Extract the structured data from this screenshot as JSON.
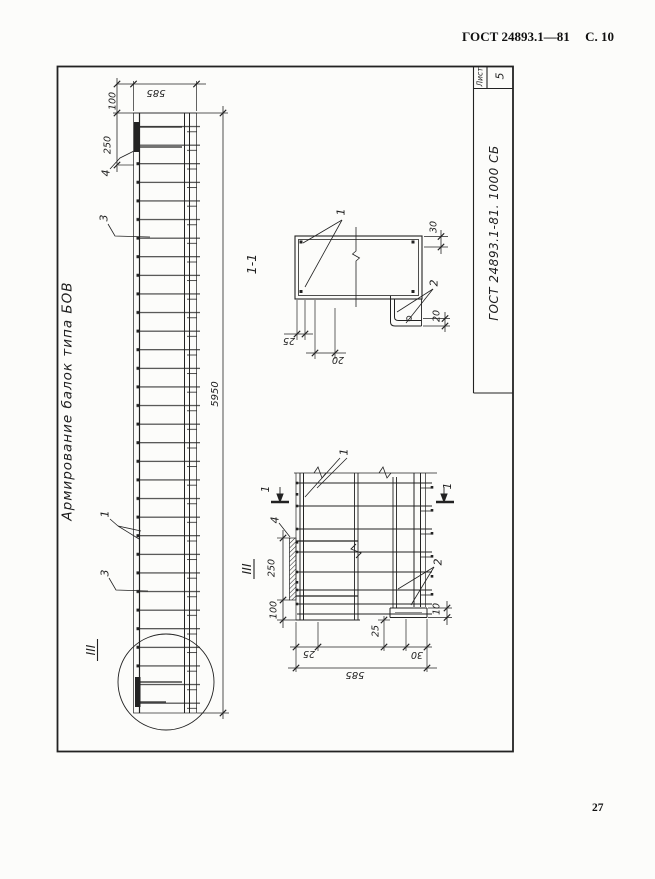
{
  "header": {
    "standard": "ГОСТ 24893.1—81",
    "page": "С. 10"
  },
  "page_number": "27",
  "title_block": {
    "doc": "ГОСТ 24893.1-81. 1000 СБ",
    "sheet_label": "Лист",
    "sheet_number": "5"
  },
  "beam": {
    "title": "Армирование балок типа БОВ",
    "dim_585": "585",
    "dim_100": "100",
    "dim_250": "250",
    "dim_5950": "5950",
    "label_4": "4",
    "label_3a": "3",
    "label_1": "1",
    "label_3b": "3",
    "label_iii": "III"
  },
  "section11": {
    "title": "1-1",
    "label_1": "1",
    "label_2": "2",
    "dim_30": "30",
    "dim_20_right": "20",
    "dim_25": "25",
    "dim_20_bottom": "20"
  },
  "detail": {
    "title": "III",
    "cut_label_left": "1",
    "cut_label_right": "1",
    "label_1": "1",
    "label_2": "2",
    "label_4": "4",
    "dim_250": "250",
    "dim_100": "100",
    "dim_25_side": "25",
    "dim_10": "10",
    "dim_25_bottom": "25",
    "dim_30_bottom": "30",
    "dim_585": "585"
  }
}
